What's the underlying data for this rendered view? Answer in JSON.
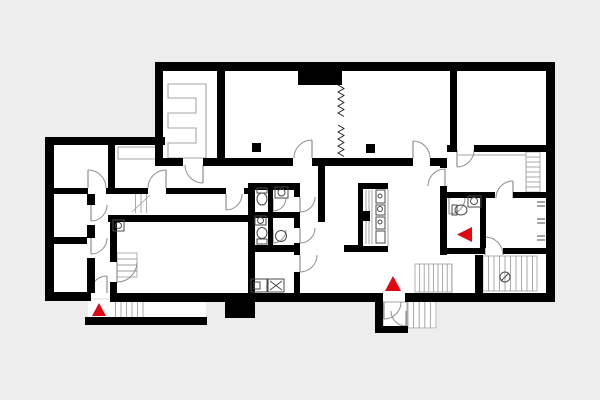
{
  "meta": {
    "description": "architectural floor plan, ground floor, black walls with red entrance markers",
    "canvas": {
      "w": 600,
      "h": 400
    }
  },
  "palette": {
    "background": "#ededed",
    "floor": "#ffffff",
    "wall": "#000000",
    "door": "#8f8f8f",
    "furniture": "#a6a6a6",
    "stair": "#9f9f9f",
    "fixture": "#4a4a4a",
    "accent_red": "#e30613"
  },
  "floor_plates": [
    {
      "name": "plate-main",
      "x": 158,
      "y": 64,
      "w": 394,
      "h": 236
    },
    {
      "name": "plate-left-wing",
      "x": 49,
      "y": 141,
      "w": 116,
      "h": 157
    },
    {
      "name": "plate-entry-stoop",
      "x": 88,
      "y": 300,
      "w": 118,
      "h": 18
    },
    {
      "name": "plate-vestibule",
      "x": 380,
      "y": 298,
      "w": 57,
      "h": 31
    }
  ],
  "walls": [
    {
      "name": "wall-outer-top",
      "x": 155,
      "y": 62,
      "w": 400,
      "h": 9
    },
    {
      "name": "wall-outer-right",
      "x": 546,
      "y": 62,
      "w": 9,
      "h": 240
    },
    {
      "name": "wall-outer-bottom-right",
      "x": 405,
      "y": 293,
      "w": 150,
      "h": 9
    },
    {
      "name": "wall-outer-bottom-mid",
      "x": 110,
      "y": 293,
      "w": 266,
      "h": 9
    },
    {
      "name": "wall-outer-bottom-left",
      "x": 45,
      "y": 292,
      "w": 46,
      "h": 9
    },
    {
      "name": "wall-stoop-bottom",
      "x": 85,
      "y": 317,
      "w": 122,
      "h": 8
    },
    {
      "name": "wall-outer-left",
      "x": 45,
      "y": 137,
      "w": 9,
      "h": 164
    },
    {
      "name": "wall-leftwing-top",
      "x": 45,
      "y": 137,
      "w": 120,
      "h": 8
    },
    {
      "name": "wall-eroom-left",
      "x": 155,
      "y": 62,
      "w": 8,
      "h": 100
    },
    {
      "name": "wall-eroom-right",
      "x": 217,
      "y": 62,
      "w": 8,
      "h": 103
    },
    {
      "name": "wall-top-protrusion",
      "x": 298,
      "y": 70,
      "w": 44,
      "h": 15
    },
    {
      "name": "wall-div158-a",
      "x": 155,
      "y": 158,
      "w": 28,
      "h": 8
    },
    {
      "name": "wall-div158-b",
      "x": 203,
      "y": 158,
      "w": 90,
      "h": 8
    },
    {
      "name": "wall-div158-c",
      "x": 312,
      "y": 158,
      "w": 101,
      "h": 8
    },
    {
      "name": "wall-div158-d",
      "x": 430,
      "y": 158,
      "w": 17,
      "h": 8
    },
    {
      "name": "wall-hall-right-a",
      "x": 440,
      "y": 158,
      "w": 7,
      "h": 10
    },
    {
      "name": "wall-hall-right-b",
      "x": 440,
      "y": 186,
      "w": 7,
      "h": 69
    },
    {
      "name": "wall-topright-h-a",
      "x": 447,
      "y": 145,
      "w": 10,
      "h": 7
    },
    {
      "name": "wall-topright-h-b",
      "x": 474,
      "y": 145,
      "w": 73,
      "h": 7
    },
    {
      "name": "wall-topright-v",
      "x": 450,
      "y": 70,
      "w": 7,
      "h": 82
    },
    {
      "name": "wall-rw192-a",
      "x": 440,
      "y": 192,
      "w": 55,
      "h": 6
    },
    {
      "name": "wall-rw192-b",
      "x": 513,
      "y": 192,
      "w": 34,
      "h": 6
    },
    {
      "name": "wall-wc-right",
      "x": 480,
      "y": 198,
      "w": 6,
      "h": 50
    },
    {
      "name": "wall-rw248-a",
      "x": 440,
      "y": 248,
      "w": 45,
      "h": 6
    },
    {
      "name": "wall-rw248-b",
      "x": 503,
      "y": 248,
      "w": 44,
      "h": 6
    },
    {
      "name": "wall-stairC-left",
      "x": 475,
      "y": 255,
      "w": 8,
      "h": 38
    },
    {
      "name": "wall-cluster-top",
      "x": 248,
      "y": 183,
      "w": 52,
      "h": 7
    },
    {
      "name": "wall-cluster-left",
      "x": 248,
      "y": 183,
      "w": 7,
      "h": 110
    },
    {
      "name": "wall-cluster-right-a",
      "x": 294,
      "y": 183,
      "w": 6,
      "h": 14
    },
    {
      "name": "wall-cluster-right-b",
      "x": 294,
      "y": 212,
      "w": 6,
      "h": 16
    },
    {
      "name": "wall-cluster-right-c",
      "x": 294,
      "y": 243,
      "w": 6,
      "h": 12
    },
    {
      "name": "wall-cluster-right-d",
      "x": 294,
      "y": 272,
      "w": 6,
      "h": 21
    },
    {
      "name": "wall-cluster-mid",
      "x": 268,
      "y": 190,
      "w": 5,
      "h": 55
    },
    {
      "name": "wall-cluster-rowdiv",
      "x": 248,
      "y": 212,
      "w": 46,
      "h": 6
    },
    {
      "name": "wall-cluster-bottomdiv",
      "x": 248,
      "y": 245,
      "w": 52,
      "h": 7
    },
    {
      "name": "wall-corridor",
      "x": 318,
      "y": 166,
      "w": 7,
      "h": 56
    },
    {
      "name": "wall-lw-top-a",
      "x": 53,
      "y": 188,
      "w": 35,
      "h": 6
    },
    {
      "name": "wall-lw-top-b",
      "x": 106,
      "y": 188,
      "w": 42,
      "h": 6
    },
    {
      "name": "wall-lw-top-c",
      "x": 166,
      "y": 188,
      "w": 60,
      "h": 6
    },
    {
      "name": "wall-lw-top-d",
      "x": 244,
      "y": 188,
      "w": 4,
      "h": 6
    },
    {
      "name": "wall-lw-vert-a",
      "x": 87,
      "y": 194,
      "w": 8,
      "h": 11
    },
    {
      "name": "wall-lw-vert-b",
      "x": 87,
      "y": 225,
      "w": 8,
      "h": 13
    },
    {
      "name": "wall-lw-vert-c",
      "x": 87,
      "y": 258,
      "w": 8,
      "h": 35
    },
    {
      "name": "wall-lw-L34div",
      "x": 53,
      "y": 237,
      "w": 34,
      "h": 7
    },
    {
      "name": "wall-lw-L12div",
      "x": 108,
      "y": 145,
      "w": 7,
      "h": 43
    },
    {
      "name": "wall-lw-c2-a",
      "x": 110,
      "y": 222,
      "w": 7,
      "h": 40
    },
    {
      "name": "wall-lw-c2-b",
      "x": 110,
      "y": 282,
      "w": 7,
      "h": 11
    },
    {
      "name": "wall-lw-L5top",
      "x": 108,
      "y": 215,
      "w": 140,
      "h": 7
    },
    {
      "name": "wall-vestibule-left",
      "x": 375,
      "y": 293,
      "w": 8,
      "h": 39
    },
    {
      "name": "wall-vestibule-bottom",
      "x": 375,
      "y": 326,
      "w": 33,
      "h": 7
    },
    {
      "name": "wall-bottom-protrusion",
      "x": 225,
      "y": 302,
      "w": 30,
      "h": 16
    },
    {
      "name": "island-top-cap",
      "x": 358,
      "y": 183,
      "w": 30,
      "h": 6
    },
    {
      "name": "island-left-wall",
      "x": 358,
      "y": 183,
      "w": 5,
      "h": 69
    },
    {
      "name": "island-bottom-cap",
      "x": 358,
      "y": 246,
      "w": 30,
      "h": 6
    },
    {
      "name": "island-block",
      "x": 362,
      "y": 211,
      "w": 8,
      "h": 10
    },
    {
      "name": "island-stub",
      "x": 344,
      "y": 245,
      "w": 14,
      "h": 7
    },
    {
      "name": "column-1",
      "x": 252,
      "y": 143,
      "w": 9,
      "h": 9
    },
    {
      "name": "column-2",
      "x": 366,
      "y": 144,
      "w": 9,
      "h": 9
    }
  ],
  "doors": [
    {
      "name": "door-eroom",
      "hx": 203,
      "hy": 165,
      "r": 18,
      "q": 3
    },
    {
      "name": "door-junction",
      "hx": 226,
      "hy": 194,
      "r": 16,
      "q": 4
    },
    {
      "name": "door-hall-left",
      "hx": 312,
      "hy": 158,
      "r": 18,
      "q": 2
    },
    {
      "name": "door-hall-mid",
      "hx": 413,
      "hy": 158,
      "r": 17,
      "q": 1
    },
    {
      "name": "door-topright-room",
      "hx": 457,
      "hy": 150,
      "r": 17,
      "q": 4
    },
    {
      "name": "door-rightwing",
      "hx": 445,
      "hy": 186,
      "r": 17,
      "q": 2
    },
    {
      "name": "door-roomA",
      "hx": 513,
      "hy": 198,
      "r": 17,
      "q": 2
    },
    {
      "name": "door-wc2",
      "hx": 449,
      "hy": 198,
      "r": 16,
      "q": 4
    },
    {
      "name": "door-roomB",
      "hx": 485,
      "hy": 255,
      "r": 18,
      "q": 1
    },
    {
      "name": "door-wc1a",
      "hx": 300,
      "hy": 197,
      "r": 15,
      "q": 4
    },
    {
      "name": "door-wc1b",
      "hx": 300,
      "hy": 228,
      "r": 15,
      "q": 4
    },
    {
      "name": "door-bath",
      "hx": 300,
      "hy": 255,
      "r": 17,
      "q": 4
    },
    {
      "name": "door-wc1a-inner",
      "hx": 273,
      "hy": 198,
      "r": 13,
      "q": 4
    },
    {
      "name": "door-wc1b-inner",
      "hx": 273,
      "hy": 230,
      "r": 13,
      "q": 4
    },
    {
      "name": "door-L1",
      "hx": 88,
      "hy": 188,
      "r": 18,
      "q": 1
    },
    {
      "name": "door-L2",
      "hx": 166,
      "hy": 188,
      "r": 18,
      "q": 2
    },
    {
      "name": "door-L3",
      "hx": 91,
      "hy": 205,
      "r": 16,
      "q": 4
    },
    {
      "name": "door-L4",
      "hx": 91,
      "hy": 238,
      "r": 16,
      "q": 4
    },
    {
      "name": "door-L5",
      "hx": 117,
      "hy": 262,
      "r": 20,
      "q": 4
    },
    {
      "name": "door-entrance",
      "hx": 107,
      "hy": 293,
      "r": 17,
      "q": 2
    },
    {
      "name": "door-vestibule-outer",
      "hx": 384,
      "hy": 302,
      "r": 17,
      "q": 4
    },
    {
      "name": "door-vestibule-inner",
      "hx": 406,
      "hy": 311,
      "r": 15,
      "q": 3
    }
  ],
  "stairs": [
    {
      "name": "stairs-stoop",
      "x": 110,
      "y": 301,
      "w": 38,
      "h": 16,
      "dir": "v",
      "step": 5.5,
      "outline": false
    },
    {
      "name": "stairs-corridor",
      "x": 130,
      "y": 194,
      "w": 22,
      "h": 19,
      "dir": "v",
      "step": 5.5,
      "outline": false,
      "diag": true
    },
    {
      "name": "stairs-L5-shelf",
      "x": 117,
      "y": 253,
      "w": 20,
      "h": 24,
      "dir": "h",
      "step": 6,
      "outline": true
    },
    {
      "name": "stairs-hall",
      "x": 415,
      "y": 264,
      "w": 37,
      "h": 28,
      "dir": "v",
      "step": 4.6,
      "outline": true
    },
    {
      "name": "stairs-roomA",
      "x": 526,
      "y": 152,
      "w": 14,
      "h": 40,
      "dir": "h",
      "step": 5,
      "outline": true
    },
    {
      "name": "stairs-roomC",
      "x": 483,
      "y": 256,
      "w": 54,
      "h": 35,
      "dir": "v",
      "step": 5.5,
      "outline": true
    },
    {
      "name": "steps-vestibule",
      "x": 408,
      "y": 294,
      "w": 28,
      "h": 34,
      "dir": "v",
      "step": 5.6,
      "outline": true
    }
  ],
  "zigzags": [
    {
      "name": "folding-partition-a",
      "x": 341,
      "y1": 85,
      "y2": 119,
      "amp": 3,
      "period": 7
    },
    {
      "name": "folding-partition-b",
      "x": 341,
      "y1": 125,
      "y2": 158,
      "amp": 3,
      "period": 7
    }
  ],
  "furniture": [
    {
      "name": "rack-e-shape",
      "type": "path",
      "d": "M168,84 H206 V158 H168 V143 H196 V128 H168 V113 H196 V98 H168 Z"
    },
    {
      "name": "counter-L2",
      "type": "rect",
      "x": 118,
      "y": 147,
      "w": 42,
      "h": 12
    },
    {
      "name": "counter-roomA",
      "type": "line",
      "x1": 458,
      "y1": 155,
      "x2": 526,
      "y2": 155
    },
    {
      "name": "rail-roomA",
      "type": "line",
      "x1": 526,
      "y1": 152,
      "x2": 526,
      "y2": 192
    },
    {
      "name": "island-right-edge",
      "type": "line",
      "x1": 388,
      "y1": 189,
      "x2": 388,
      "y2": 246
    },
    {
      "name": "island-hatch-1",
      "type": "line",
      "x1": 366,
      "y1": 190,
      "x2": 366,
      "y2": 244
    },
    {
      "name": "island-hatch-2",
      "type": "line",
      "x1": 369,
      "y1": 190,
      "x2": 369,
      "y2": 244
    },
    {
      "name": "island-hatch-3",
      "type": "line",
      "x1": 372,
      "y1": 190,
      "x2": 372,
      "y2": 244
    },
    {
      "name": "vestibule-box",
      "type": "rect",
      "x": 383,
      "y": 302,
      "w": 24,
      "h": 28
    }
  ],
  "fixtures": [
    {
      "name": "toilet-icon",
      "type": "toilet",
      "tank": [
        257,
        188,
        10,
        5
      ],
      "bowl": [
        262,
        199,
        5,
        6
      ]
    },
    {
      "name": "sink-icon",
      "type": "sink",
      "box": [
        275,
        187,
        13,
        11
      ],
      "c": [
        281.5,
        192.5,
        3.5
      ]
    },
    {
      "name": "sink-icon",
      "type": "sink",
      "box": [
        255,
        216,
        11,
        9
      ],
      "c": [
        260.5,
        220.5,
        3
      ]
    },
    {
      "name": "toilet-icon",
      "type": "toilet",
      "tank": [
        257,
        239,
        10,
        5
      ],
      "bowl": [
        262,
        233,
        5,
        5.5
      ]
    },
    {
      "name": "basin-icon",
      "type": "circle",
      "c": [
        281,
        236,
        5.5
      ]
    },
    {
      "name": "dishwasher-icon",
      "type": "machine",
      "box": [
        251,
        279,
        16,
        13
      ],
      "inner": [
        254,
        282,
        6,
        7
      ]
    },
    {
      "name": "washer-icon",
      "type": "machine",
      "box": [
        268,
        279,
        16,
        13
      ],
      "cross": true
    },
    {
      "name": "toilet-icon",
      "type": "toilet",
      "tank": [
        452,
        205,
        5,
        10
      ],
      "bowl": [
        461,
        210,
        6,
        5
      ]
    },
    {
      "name": "sink-icon",
      "type": "sink",
      "box": [
        468,
        196,
        13,
        11
      ],
      "c": [
        474,
        201,
        3.5
      ]
    },
    {
      "name": "sink-icon",
      "type": "sink",
      "box": [
        113,
        220,
        11,
        11
      ],
      "c": [
        118.5,
        225.5,
        3
      ]
    },
    {
      "name": "cooktop-icon",
      "type": "sink",
      "box": [
        376,
        190,
        9,
        13
      ],
      "c": [
        380,
        196,
        2
      ]
    },
    {
      "name": "island-sink-icon",
      "type": "sink",
      "box": [
        376,
        205,
        9,
        10
      ],
      "c": [
        380,
        209,
        2.5
      ]
    },
    {
      "name": "island-unit-icon",
      "type": "sink",
      "box": [
        376,
        217,
        9,
        12
      ],
      "c": [
        380,
        222,
        2
      ]
    },
    {
      "name": "island-unit-icon",
      "type": "box",
      "box": [
        376,
        231,
        9,
        12
      ]
    },
    {
      "name": "shelf-tick-icon",
      "type": "tick",
      "p": [
        537,
        204
      ]
    },
    {
      "name": "shelf-tick-icon",
      "type": "tick",
      "p": [
        537,
        221
      ]
    },
    {
      "name": "shelf-tick-icon",
      "type": "tick",
      "p": [
        537,
        238
      ]
    },
    {
      "name": "stair-direction-icon",
      "type": "arrowcircle",
      "c": [
        505,
        277,
        5
      ]
    }
  ],
  "markers": [
    {
      "name": "entrance-marker-left",
      "points": "92,316 106,316 99,303"
    },
    {
      "name": "entrance-marker-center",
      "points": "385,291 401,291 393,276"
    },
    {
      "name": "entrance-marker-right",
      "points": "472,227 472,242 457,234.5"
    }
  ]
}
